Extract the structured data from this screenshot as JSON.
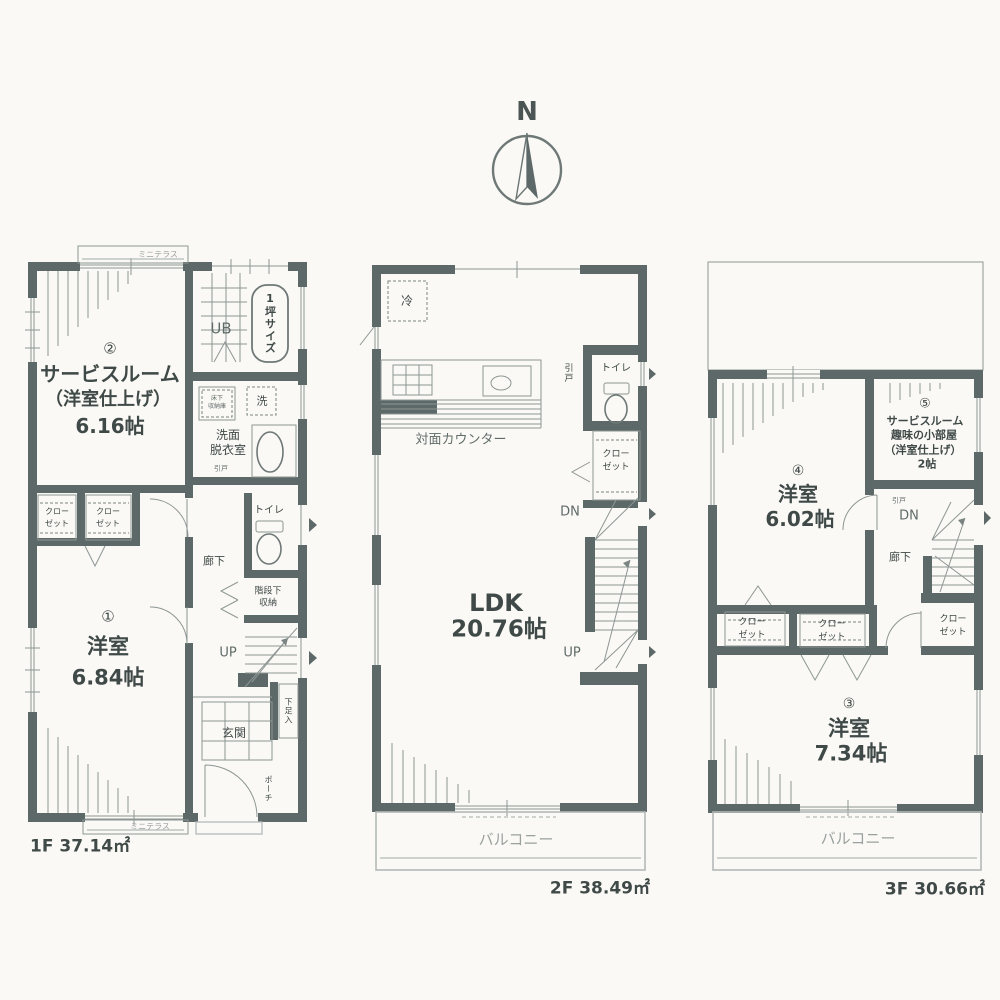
{
  "compass": {
    "n": "N"
  },
  "colors": {
    "wall": "#5d6968",
    "thin_line": "#8d9694",
    "light_line": "#b3bab8",
    "text": "#3f4947"
  },
  "f1": {
    "area_label": "1F 37.14㎡",
    "terrace_top": "ミニテラス",
    "terrace_bottom": "ミニテラス",
    "room2_no": "②",
    "room2_name": "サービスルーム",
    "room2_sub": "（洋室仕上げ）",
    "room2_area": "6.16帖",
    "ub": "UB",
    "tsubo": "1坪サイズ",
    "underfloor1": "床下",
    "underfloor2": "収納庫",
    "washer": "洗",
    "wash1": "洗面",
    "wash2": "脱衣室",
    "door_wash": "引戸",
    "closet1a": "クロー",
    "closet1b": "ゼット",
    "closet2a": "クロー",
    "closet2b": "ゼット",
    "room1_no": "①",
    "room1_name": "洋室",
    "room1_area": "6.84帖",
    "hall": "廊下",
    "toilet": "トイレ",
    "understairs1": "階段下",
    "understairs2": "収納",
    "up": "UP",
    "shoe": "下足入",
    "entrance": "玄関",
    "porch": "ポーチ"
  },
  "f2": {
    "area_label": "2F 38.49㎡",
    "fridge": "冷",
    "counter": "対面カウンター",
    "door": "引戸",
    "toilet": "トイレ",
    "closeta": "クロー",
    "closetb": "ゼット",
    "dn": "DN",
    "up": "UP",
    "ldk": "LDK",
    "ldk_area": "20.76帖",
    "balcony": "バルコニー"
  },
  "f3": {
    "area_label": "3F 30.66㎡",
    "room4_no": "④",
    "room4_name": "洋室",
    "room4_area": "6.02帖",
    "room5_no": "⑤",
    "room5_l1": "サービスルーム",
    "room5_l2": "趣味の小部屋",
    "room5_l3": "（洋室仕上げ）",
    "room5_l4": "2帖",
    "door": "引戸",
    "dn": "DN",
    "hall": "廊下",
    "closetra": "クロー",
    "closetrb": "ゼット",
    "closetaa": "クロー",
    "closetab": "ゼット",
    "closetba": "クロー",
    "closetbb": "ゼット",
    "room3_no": "③",
    "room3_name": "洋室",
    "room3_area": "7.34帖",
    "balcony": "バルコニー"
  }
}
